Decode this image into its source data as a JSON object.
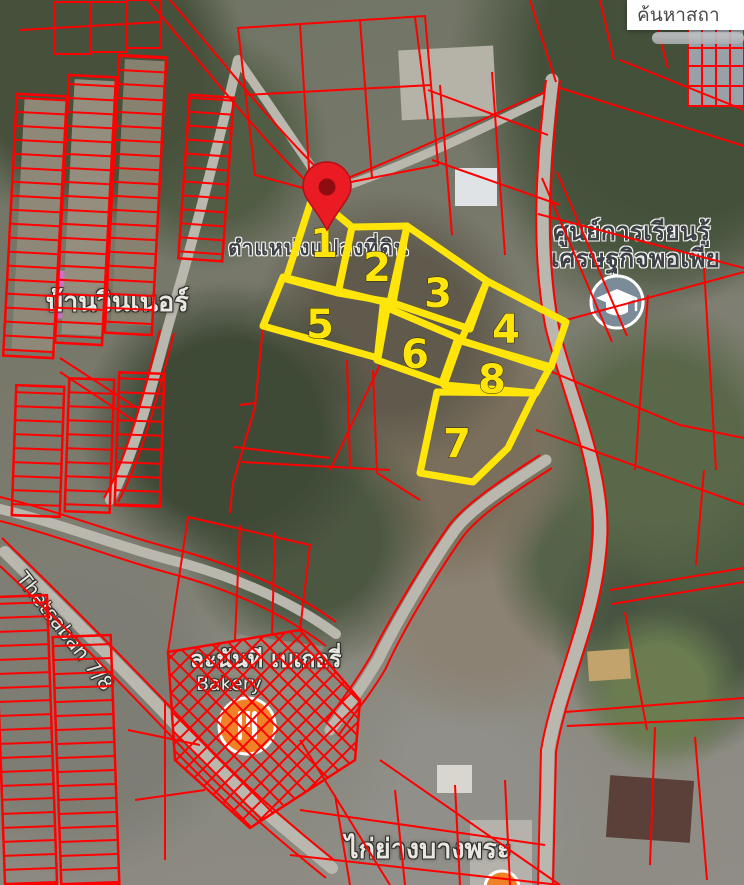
{
  "search": {
    "text": "ค้นหาสถา"
  },
  "overlay": {
    "position_label": "ตำแหน่งแปลงที่ดิน",
    "pin_color": "#ea1b23",
    "parcel_highlight_color": "#ffe50a",
    "cadastral_line_color": "#ff0000",
    "parcels": [
      {
        "label": "1"
      },
      {
        "label": "2"
      },
      {
        "label": "3"
      },
      {
        "label": "4"
      },
      {
        "label": "5"
      },
      {
        "label": "6"
      },
      {
        "label": "7"
      },
      {
        "label": "8"
      }
    ]
  },
  "map_labels": {
    "village": "บ้านวินเนอร์",
    "learning_center_line1": "ศูนย์การเรียนรู้",
    "learning_center_line2": "เศรษฐกิจพอเพีย",
    "road": "Thetsaban 7/8",
    "bakery_thai": "ละนันที เบเกอรี่",
    "bakery_en": "Bakery",
    "restaurant": "ไก่ย่างบางพระ"
  },
  "icons": {
    "school": "graduation-cap",
    "bakery": "restaurant",
    "restaurant_partial": "restaurant"
  },
  "colors": {
    "school_icon_bg": "#7b8b97",
    "poi_orange": "#ef8126",
    "road_gray": "#b9b7ae"
  }
}
